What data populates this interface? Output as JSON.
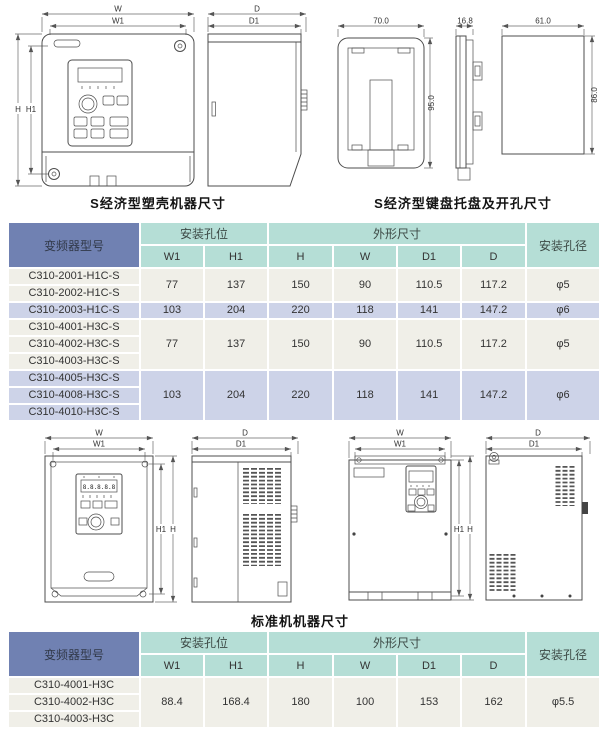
{
  "captions": {
    "s_plastic_machine": "S经济型塑壳机器尺寸",
    "s_keypad_tray": "S经济型键盘托盘及开孔尺寸",
    "standard_machine": "标准机机器尺寸"
  },
  "diagram_labels": {
    "w": "W",
    "w1": "W1",
    "h": "H",
    "h1": "H1",
    "d": "D",
    "d1": "D1",
    "tray_width": "70.0",
    "tray_height": "95.0",
    "tray_depth": "16.8",
    "cutout_width": "61.0",
    "cutout_height": "86.0",
    "led_display": "8.8.8.8.8"
  },
  "table_headers": {
    "model": "变频器型号",
    "mounting_holes": "安装孔位",
    "outline_dims": "外形尺寸",
    "hole_diameter": "安装孔径",
    "w1": "W1",
    "h1": "H1",
    "h": "H",
    "w": "W",
    "d1": "D1",
    "d": "D"
  },
  "s_economy_table": {
    "groups": [
      {
        "models": [
          "C310-2001-H1C-S",
          "C310-2002-H1C-S"
        ],
        "w1": "77",
        "h1": "137",
        "h": "150",
        "w": "90",
        "d1": "110.5",
        "d": "117.2",
        "dia": "φ5"
      },
      {
        "models": [
          "C310-2003-H1C-S"
        ],
        "w1": "103",
        "h1": "204",
        "h": "220",
        "w": "118",
        "d1": "141",
        "d": "147.2",
        "dia": "φ6"
      },
      {
        "models": [
          "C310-4001-H3C-S",
          "C310-4002-H3C-S",
          "C310-4003-H3C-S"
        ],
        "w1": "77",
        "h1": "137",
        "h": "150",
        "w": "90",
        "d1": "110.5",
        "d": "117.2",
        "dia": "φ5"
      },
      {
        "models": [
          "C310-4005-H3C-S",
          "C310-4008-H3C-S",
          "C310-4010-H3C-S"
        ],
        "w1": "103",
        "h1": "204",
        "h": "220",
        "w": "118",
        "d1": "141",
        "d": "147.2",
        "dia": "φ6"
      }
    ]
  },
  "standard_table": {
    "groups": [
      {
        "models": [
          "C310-4001-H3C",
          "C310-4002-H3C",
          "C310-4003-H3C"
        ],
        "w1": "88.4",
        "h1": "168.4",
        "h": "180",
        "w": "100",
        "d1": "153",
        "d": "162",
        "dia": "φ5.5"
      }
    ]
  },
  "colors": {
    "header_blue": "#7081b2",
    "header_teal": "#b5ded6",
    "row_light": "#f0efe8",
    "row_lavender": "#cdd3e8"
  }
}
